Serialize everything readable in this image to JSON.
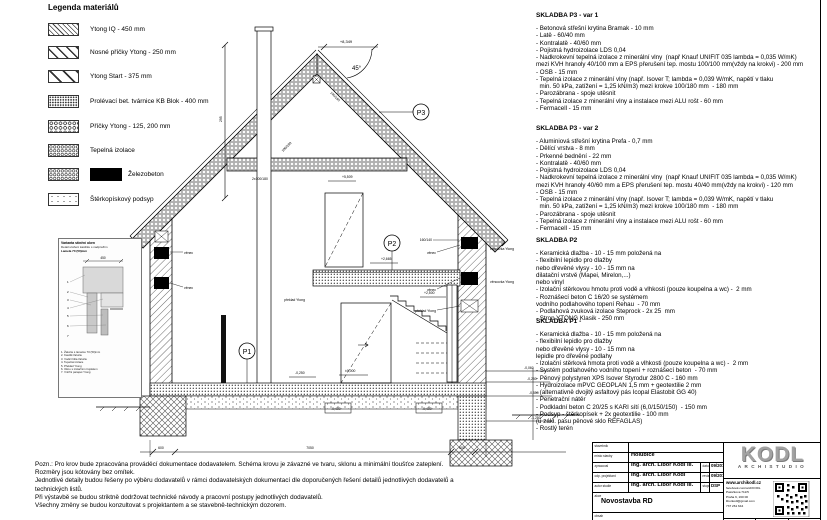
{
  "legend": {
    "title": "Legenda materiálů",
    "items": [
      {
        "name": "ytong-iq",
        "label": "Ytong IQ - 450 mm"
      },
      {
        "name": "nosne-pricky",
        "label": "Nosné příčky Ytong - 250 mm"
      },
      {
        "name": "ytong-start",
        "label": "Ytong Start - 375 mm"
      },
      {
        "name": "kb-blok",
        "label": "Prolévací bet. tvárnice KB Blok - 400 mm"
      },
      {
        "name": "pricky",
        "label": "Příčky Ytong - 125, 200 mm"
      },
      {
        "name": "izolace",
        "label": "Tepelná izolace"
      },
      {
        "name": "zelezobeton",
        "label": "Železobeton"
      },
      {
        "name": "sterk",
        "label": "Štěrkopískový podsyp"
      }
    ]
  },
  "skladby": {
    "p3v1": {
      "title": "SKLADBA P3 - var 1",
      "body": "- Betonová střešní krytina Bramak - 10 mm\n- Latě - 60/40 mm\n- Kontralatě - 40/60 mm\n- Pojistná hydroizolace LDS 0,04\n- Nadkrokevní tepelná izolace z minerální vlny  (např Knauf UNIFIT 035 lambda = 0,035 W/mK)\nmezi KVH hranoly 40/100 mm a EPS přerušení tep. mostu 100/100 mm(vždy na krokvi) - 200 mm\n- OSB - 15 mm\n- Tepelná izolace z minerální vlny (např. Isover T; lambda = 0,039 W/mK, napětí v tlaku\n  min. 50 kPa, zatížení = 1,25 kN/m3) mezi krokve 100/180 mm  - 180 mm\n- Parozábrana - spoje utěsnit\n- Tepelná izolace z minerální vlny a instalace mezi ALU rošt - 60 mm\n- Fermacell - 15 mm"
    },
    "p3v2": {
      "title": "SKLADBA P3 - var 2",
      "body": "- Aluminiová střešní krytina Prefa - 0,7 mm\n- Dělící vrstva - 8 mm\n- Prkenné bednění - 22 mm\n- Kontralatě - 40/60 mm\n- Pojistná hydroizolace LDS 0,04\n- Nadkrokevní tepelná izolace z minerální vlny  (např Knauf UNIFIT 035 lambda = 0,035 W/mK)\nmezi KVH hranoly 40/60 mm a EPS přerušení tep. mostu 40/40 mm(vždy na krokvi) - 120 mm\n- OSB - 15 mm\n- Tepelná izolace z minerální vlny (např. Isover T; lambda = 0,039 W/mK, napětí v tlaku\n  min. 50 kPa, zatížení = 1,25 kN/m3) mezi krokve 100/180 mm  - 180 mm\n- Parozábrana - spoje utěsnit\n- Tepelná izolace z minerální vlny a instalace mezi ALU rošt - 60 mm\n- Fermacell - 15 mm"
    },
    "p2": {
      "title": "SKLADBA P2",
      "body": "- Keramická dlažba - 10 - 15 mm položená na\n- flexibilní lepidlo pro dlažby\nnebo dřevěné vlysy - 10 - 15 mm na\ndilatační vrstvě (Mapei, Mirelon,...)\nnebo vinyl\n- Izolační stěrkovou hmotu proti vodě a vlhkosti (pouze koupelna a wc) -  2 mm\n- Roznášecí beton C 16/20 se systémem\nvodního podlahového topení Rehau  - 70 mm\n- Podlahová zvuková izolace Steprock - 2x 25  mm\n- Strop YTONG Klasik - 250 mm"
    },
    "p1": {
      "title": "SKLADBA P1 -",
      "body": "- Keramická dlažba - 10 - 15 mm položená na\n- flexibilní lepidlo pro dlažby\nnebo dřevěné vlysy - 10 - 15 mm na\nlepidle pro dřevěné podlahy\n- Izolační stěrková hmota proti vodě a vlhkosti (pouze koupelna a wc) -  2 mm\n- Systém podlahového vodního topení + roznášecí beton  - 70 mm\n- Pěnový polystyren XPS Isover Styrodur 2800 C - 160 mm\n- Hydroizolace mPVC GEOPLAN 1,5 mm + geotextilie 2 mm\n- (alternativně dvojitý asfaltový pás Icopal Elastobit GG 40)\n- Penetrační nátěr\n- Podkladní beton C 20/25 s KARI sítí (6,0/150/150)  - 150 mm\n- Podsyp - štěrkopísek + 2x geotextilie - 100 mm\n(u zákl. pasu pěnové sklo REFAGLAS)\n- Rostlý terén"
    }
  },
  "notes": {
    "body": "Pozn.: Pro krov bude zpracována prováděcí dokumentace dodavatelem. Schéma krovu je závazné ve tvaru, sklonu a minimální tloušťce zateplení.\nRozměry jsou kótovány bez omítek.\nJednotlivé detaily budou řešeny po výběru dodavatelů v rámci dodavatelských dokumentací dle doporučených řešení detailů jednotlivých dodavatelů a\ntechnických listů.\nPři výstavbě se budou striktně dodržovat technické návody a pracovní postupy jednotlivých dodavatelů.\nVšechny změny se budou konzultovat s projektantem a se stavebně-technickým dozorem."
  },
  "inset": {
    "title1": "Varianta stínění oken",
    "title2": "Detail uložení kastlíku s nadpražím",
    "title3": "Lamela 70 (50)mm",
    "dim": "450",
    "notes": "1. Žaluzie s lamelou 70 (50)mm\n2. Kastlík žaluzie\n3. Vodicí lišta žaluzie\n4. Tepelná izolace\n5. Překlad Ytong\n6. Okno s izolačním trojsklem\n7. Vnitřní parapet Ytong"
  },
  "drawing": {
    "markers": {
      "p1": "P1",
      "p2": "P2",
      "p3": "P3"
    },
    "labels": {
      "angle": "45°",
      "collar": "2x100/180",
      "rafter_l": "100/180",
      "rafter_r": "140/160",
      "pozednice": "160/140",
      "venec": "věnec",
      "vencovka": "věncovka Ytong",
      "preklad": "překlad Ytong",
      "dim_vert": "295"
    },
    "elevations": {
      "ridge": "+8,349",
      "collar": "+5,509",
      "p2": "+2,665",
      "stair": "+2,500",
      "zero": "±0,000",
      "m025": "-0,250",
      "m040": "-0,400",
      "m006": "-0,060",
      "m025r": "-0,250",
      "m055": "-0,550",
      "m125": "-1,250"
    },
    "dims": {
      "left": "600",
      "mid": "7050",
      "right": "600"
    }
  },
  "titleblock": {
    "rows": {
      "stavebnik_lbl": "stavebník",
      "stavebnik": "",
      "misto_lbl": "místo stavby",
      "misto": "Holubice",
      "zpracoval_lbl": "zpracoval",
      "zpracoval": "Ing. arch. Libor Kodl III.",
      "datum_lbl": "datum",
      "datum": "09/2018",
      "odp_lbl": "odp. projektant",
      "odp": "Ing. arch. Libor Kodl",
      "revize_lbl": "revize",
      "revize": "09/2018",
      "autor_lbl": "autor studie",
      "autor": "Ing. arch. Libor Kodl III.",
      "stupen_lbl": "stupeň",
      "stupen": "DSP",
      "akce_lbl": "akce",
      "akce": "Novostavba RD",
      "obsah_lbl": "obsah",
      "obsah": "Schematický řez A - A'"
    },
    "company": {
      "logo": "KODL",
      "studio": "ARCHISTUDIO",
      "web": "www.archikodl.cz",
      "fb": "facebook.com/archKODL",
      "addr1": "Patočkova 711/5",
      "addr2": "Praha 6, 160 00",
      "email": "liborkodl@gmail.com",
      "phone": "737 261 644"
    },
    "bottom": {
      "format": "formát",
      "meritko": "měřítko",
      "cislo": "číslo výkresu"
    }
  }
}
